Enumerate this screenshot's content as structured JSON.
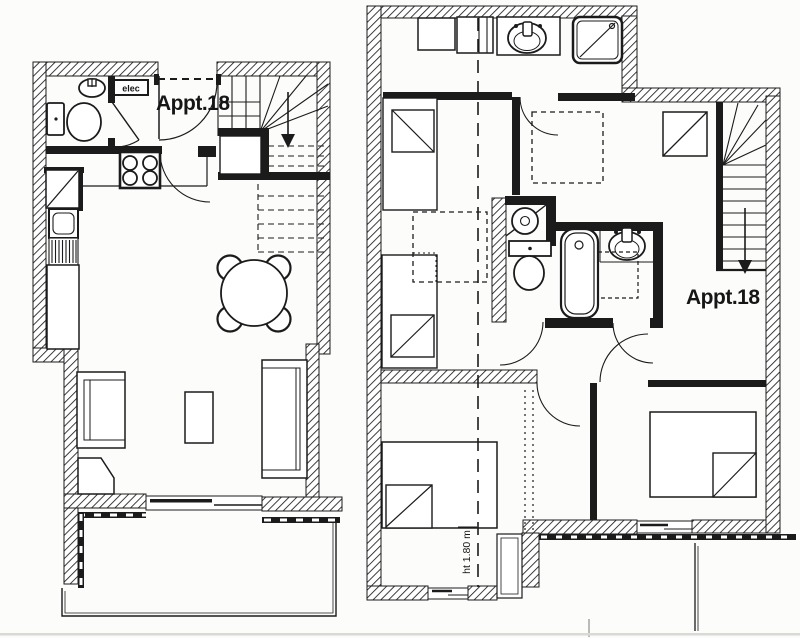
{
  "document": {
    "type": "architectural-floor-plan",
    "paper_color": "#fcfcfb",
    "ink_color": "#1b1b1b"
  },
  "plans": [
    {
      "id": "plan-lower-level",
      "label": "Appt.18",
      "annotations": {
        "elec": "elec"
      },
      "fixtures": [
        "toilet",
        "washbasin",
        "electrical-panel",
        "winder-staircase-down",
        "stove-4-burners",
        "refrigerator",
        "kitchen-sink-drainboard",
        "counter",
        "round-dining-table",
        "four-chairs",
        "sofa-left",
        "sofa-right",
        "coffee-table",
        "armchair",
        "window-sliding",
        "balcony-railing"
      ]
    },
    {
      "id": "plan-upper-level",
      "label": "Appt.18",
      "annotations": {
        "height_note": "ht 1.80 m"
      },
      "fixtures": [
        "cabinet",
        "wardrobe-cells",
        "washbasin-counter",
        "shower-tray",
        "single-bed",
        "single-bed",
        "under-eaves-storage-dashed",
        "corner-basin",
        "toilet",
        "bathtub",
        "washbasin",
        "wardrobe-diagonal",
        "staircase-down",
        "double-bed",
        "double-bed",
        "window",
        "balcony-railing",
        "height-limit-dashed-line"
      ]
    }
  ]
}
